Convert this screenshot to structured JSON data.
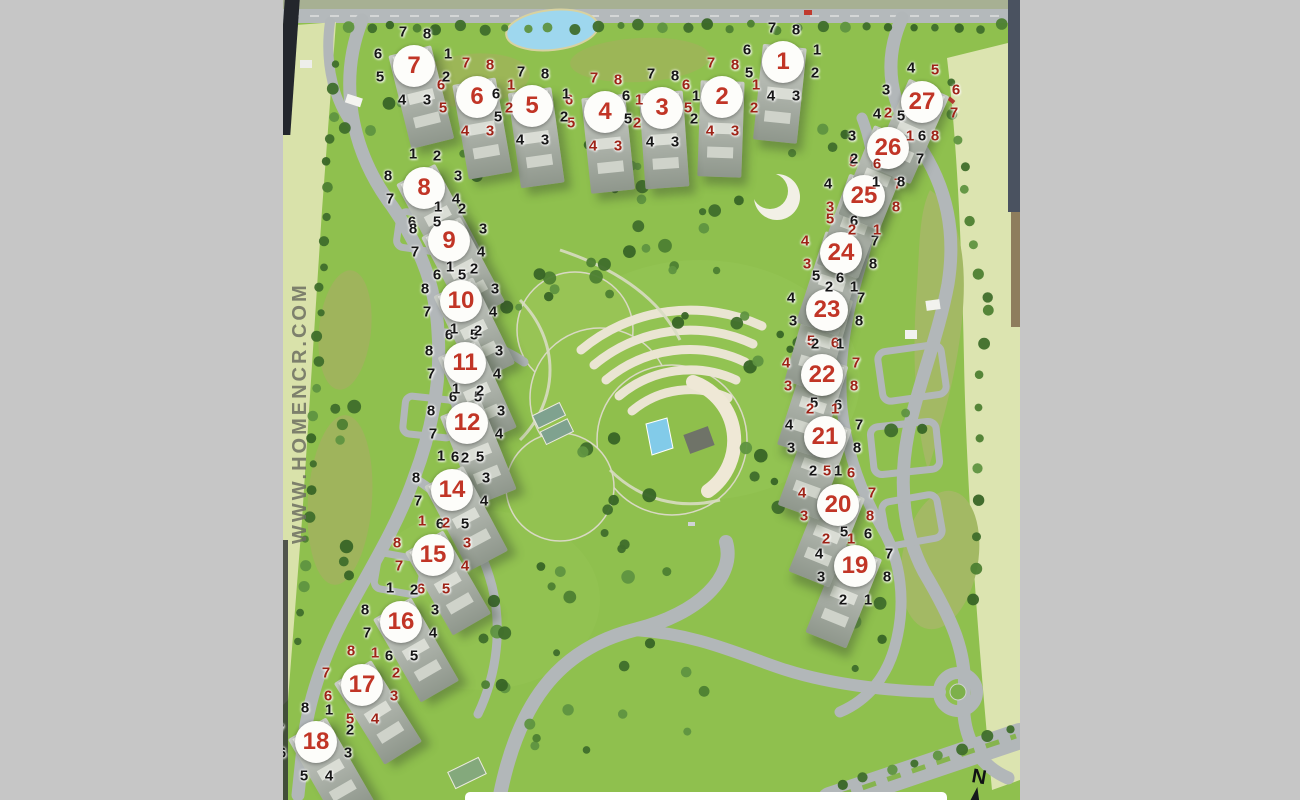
{
  "watermark": "WWW.HOMENCR.COM",
  "compass": {
    "label": "N"
  },
  "colors": {
    "grass": "#8fc04e",
    "pale_band": "#dbe3ac",
    "golf_olive": "#a3b964",
    "road": "#b2b7b9",
    "water": "#8fd0ea",
    "tower_number_red": "#c13526",
    "unit_digit_black": "#161616",
    "unit_digit_red": "#9e2317",
    "badge_white": "#fdfdfa"
  },
  "towers": [
    {
      "label": "1",
      "x": 783,
      "y": 62,
      "rot": 6,
      "digits": [
        [
          "7",
          "k"
        ],
        [
          "8",
          "k"
        ],
        [
          "1",
          "k"
        ],
        [
          "2",
          "k"
        ],
        [
          "3",
          "k"
        ],
        [
          "4",
          "k"
        ],
        [
          "5",
          "k"
        ],
        [
          "6",
          "k"
        ]
      ]
    },
    {
      "label": "2",
      "x": 722,
      "y": 97,
      "rot": 2,
      "digits": [
        [
          "7",
          "r"
        ],
        [
          "8",
          "r"
        ],
        [
          "1",
          "r"
        ],
        [
          "2",
          "r"
        ],
        [
          "3",
          "r"
        ],
        [
          "4",
          "r"
        ],
        [
          "5",
          "r"
        ],
        [
          "6",
          "r"
        ]
      ]
    },
    {
      "label": "3",
      "x": 662,
      "y": 108,
      "rot": -4,
      "digits": [
        [
          "7",
          "k"
        ],
        [
          "8",
          "k"
        ],
        [
          "1",
          "k"
        ],
        [
          "2",
          "k"
        ],
        [
          "3",
          "k"
        ],
        [
          "4",
          "k"
        ],
        [
          "5",
          "k"
        ],
        [
          "6",
          "k"
        ]
      ]
    },
    {
      "label": "4",
      "x": 605,
      "y": 112,
      "rot": -6,
      "digits": [
        [
          "7",
          "r"
        ],
        [
          "8",
          "r"
        ],
        [
          "1",
          "r"
        ],
        [
          "2",
          "r"
        ],
        [
          "3",
          "r"
        ],
        [
          "4",
          "r"
        ],
        [
          "5",
          "r"
        ],
        [
          "6",
          "r"
        ]
      ]
    },
    {
      "label": "5",
      "x": 532,
      "y": 106,
      "rot": -8,
      "digits": [
        [
          "7",
          "k"
        ],
        [
          "8",
          "k"
        ],
        [
          "1",
          "k"
        ],
        [
          "2",
          "k"
        ],
        [
          "3",
          "k"
        ],
        [
          "4",
          "k"
        ],
        [
          "5",
          "k"
        ],
        [
          "6",
          "k"
        ]
      ]
    },
    {
      "label": "6",
      "x": 477,
      "y": 97,
      "rot": -10,
      "digits": [
        [
          "7",
          "r"
        ],
        [
          "8",
          "r"
        ],
        [
          "1",
          "r"
        ],
        [
          "2",
          "r"
        ],
        [
          "3",
          "r"
        ],
        [
          "4",
          "r"
        ],
        [
          "5",
          "r"
        ],
        [
          "6",
          "r"
        ]
      ]
    },
    {
      "label": "7",
      "x": 414,
      "y": 66,
      "rot": -14,
      "digits": [
        [
          "7",
          "k"
        ],
        [
          "8",
          "k"
        ],
        [
          "1",
          "k"
        ],
        [
          "2",
          "k"
        ],
        [
          "3",
          "k"
        ],
        [
          "4",
          "k"
        ],
        [
          "5",
          "k"
        ],
        [
          "6",
          "k"
        ]
      ]
    },
    {
      "label": "8",
      "x": 424,
      "y": 188,
      "rot": -28,
      "digits": [
        [
          "1",
          "k"
        ],
        [
          "2",
          "k"
        ],
        [
          "3",
          "k"
        ],
        [
          "4",
          "k"
        ],
        [
          "5",
          "k"
        ],
        [
          "6",
          "k"
        ],
        [
          "7",
          "k"
        ],
        [
          "8",
          "k"
        ]
      ]
    },
    {
      "label": "9",
      "x": 449,
      "y": 241,
      "rot": -28,
      "digits": [
        [
          "1",
          "k"
        ],
        [
          "2",
          "k"
        ],
        [
          "3",
          "k"
        ],
        [
          "4",
          "k"
        ],
        [
          "5",
          "k"
        ],
        [
          "6",
          "k"
        ],
        [
          "7",
          "k"
        ],
        [
          "8",
          "k"
        ]
      ]
    },
    {
      "label": "10",
      "x": 461,
      "y": 301,
      "rot": -26,
      "digits": [
        [
          "1",
          "k"
        ],
        [
          "2",
          "k"
        ],
        [
          "3",
          "k"
        ],
        [
          "4",
          "k"
        ],
        [
          "5",
          "k"
        ],
        [
          "6",
          "k"
        ],
        [
          "7",
          "k"
        ],
        [
          "8",
          "k"
        ]
      ]
    },
    {
      "label": "11",
      "x": 465,
      "y": 363,
      "rot": -24,
      "digits": [
        [
          "1",
          "k"
        ],
        [
          "2",
          "k"
        ],
        [
          "3",
          "k"
        ],
        [
          "4",
          "k"
        ],
        [
          "5",
          "k"
        ],
        [
          "6",
          "k"
        ],
        [
          "7",
          "k"
        ],
        [
          "8",
          "k"
        ]
      ]
    },
    {
      "label": "12",
      "x": 467,
      "y": 423,
      "rot": -22,
      "digits": [
        [
          "1",
          "k"
        ],
        [
          "2",
          "k"
        ],
        [
          "3",
          "k"
        ],
        [
          "4",
          "k"
        ],
        [
          "5",
          "k"
        ],
        [
          "6",
          "k"
        ],
        [
          "7",
          "k"
        ],
        [
          "8",
          "k"
        ]
      ]
    },
    {
      "label": "14",
      "x": 452,
      "y": 490,
      "rot": -28,
      "digits": [
        [
          "1",
          "k"
        ],
        [
          "2",
          "k"
        ],
        [
          "3",
          "k"
        ],
        [
          "4",
          "k"
        ],
        [
          "5",
          "k"
        ],
        [
          "6",
          "k"
        ],
        [
          "7",
          "k"
        ],
        [
          "8",
          "k"
        ]
      ]
    },
    {
      "label": "15",
      "x": 433,
      "y": 555,
      "rot": -30,
      "digits": [
        [
          "1",
          "r"
        ],
        [
          "2",
          "r"
        ],
        [
          "3",
          "r"
        ],
        [
          "4",
          "r"
        ],
        [
          "5",
          "r"
        ],
        [
          "6",
          "r"
        ],
        [
          "7",
          "r"
        ],
        [
          "8",
          "r"
        ]
      ]
    },
    {
      "label": "16",
      "x": 401,
      "y": 622,
      "rot": -30,
      "digits": [
        [
          "1",
          "k"
        ],
        [
          "2",
          "k"
        ],
        [
          "3",
          "k"
        ],
        [
          "4",
          "k"
        ],
        [
          "5",
          "k"
        ],
        [
          "6",
          "k"
        ],
        [
          "7",
          "k"
        ],
        [
          "8",
          "k"
        ]
      ]
    },
    {
      "label": "17",
      "x": 362,
      "y": 685,
      "rot": -32,
      "digits": [
        [
          "8",
          "r"
        ],
        [
          "1",
          "r"
        ],
        [
          "2",
          "r"
        ],
        [
          "3",
          "r"
        ],
        [
          "4",
          "r"
        ],
        [
          "5",
          "r"
        ],
        [
          "6",
          "r"
        ],
        [
          "7",
          "r"
        ]
      ]
    },
    {
      "label": "18",
      "x": 316,
      "y": 742,
      "rot": -30,
      "digits": [
        [
          "8",
          "k"
        ],
        [
          "1",
          "k"
        ],
        [
          "2",
          "k"
        ],
        [
          "3",
          "k"
        ],
        [
          "4",
          "k"
        ],
        [
          "5",
          "k"
        ],
        [
          "6",
          "k"
        ],
        [
          "7",
          "k"
        ]
      ]
    },
    {
      "label": "19",
      "x": 855,
      "y": 566,
      "rot": 22,
      "digits": [
        [
          "5",
          "k"
        ],
        [
          "6",
          "k"
        ],
        [
          "7",
          "k"
        ],
        [
          "8",
          "k"
        ],
        [
          "1",
          "k"
        ],
        [
          "2",
          "k"
        ],
        [
          "3",
          "k"
        ],
        [
          "4",
          "k"
        ]
      ]
    },
    {
      "label": "20",
      "x": 838,
      "y": 505,
      "rot": 22,
      "digits": [
        [
          "5",
          "r"
        ],
        [
          "6",
          "r"
        ],
        [
          "7",
          "r"
        ],
        [
          "8",
          "r"
        ],
        [
          "1",
          "r"
        ],
        [
          "2",
          "r"
        ],
        [
          "3",
          "r"
        ],
        [
          "4",
          "r"
        ]
      ]
    },
    {
      "label": "21",
      "x": 825,
      "y": 437,
      "rot": 20,
      "digits": [
        [
          "5",
          "k"
        ],
        [
          "6",
          "k"
        ],
        [
          "7",
          "k"
        ],
        [
          "8",
          "k"
        ],
        [
          "1",
          "k"
        ],
        [
          "2",
          "k"
        ],
        [
          "3",
          "k"
        ],
        [
          "4",
          "k"
        ]
      ]
    },
    {
      "label": "22",
      "x": 822,
      "y": 375,
      "rot": 18,
      "digits": [
        [
          "5",
          "r"
        ],
        [
          "6",
          "r"
        ],
        [
          "7",
          "r"
        ],
        [
          "8",
          "r"
        ],
        [
          "1",
          "r"
        ],
        [
          "2",
          "r"
        ],
        [
          "3",
          "r"
        ],
        [
          "4",
          "r"
        ]
      ]
    },
    {
      "label": "23",
      "x": 827,
      "y": 310,
      "rot": 16,
      "digits": [
        [
          "5",
          "k"
        ],
        [
          "6",
          "k"
        ],
        [
          "7",
          "k"
        ],
        [
          "8",
          "k"
        ],
        [
          "1",
          "k"
        ],
        [
          "2",
          "k"
        ],
        [
          "3",
          "k"
        ],
        [
          "4",
          "k"
        ]
      ]
    },
    {
      "label": "24",
      "x": 841,
      "y": 253,
      "rot": 18,
      "digits": [
        [
          "5",
          "r"
        ],
        [
          "6",
          "k"
        ],
        [
          "7",
          "k"
        ],
        [
          "8",
          "k"
        ],
        [
          "1",
          "k"
        ],
        [
          "2",
          "k"
        ],
        [
          "3",
          "r"
        ],
        [
          "4",
          "r"
        ]
      ]
    },
    {
      "label": "25",
      "x": 864,
      "y": 196,
      "rot": 20,
      "digits": [
        [
          "5",
          "r"
        ],
        [
          "6",
          "r"
        ],
        [
          "7",
          "r"
        ],
        [
          "8",
          "r"
        ],
        [
          "1",
          "r"
        ],
        [
          "2",
          "r"
        ],
        [
          "3",
          "r"
        ],
        [
          "4",
          "k"
        ]
      ]
    },
    {
      "label": "26",
      "x": 888,
      "y": 148,
      "rot": 22,
      "digits": [
        [
          "4",
          "k"
        ],
        [
          "5",
          "k"
        ],
        [
          "6",
          "k"
        ],
        [
          "7",
          "k"
        ],
        [
          "8",
          "k"
        ],
        [
          "1",
          "k"
        ],
        [
          "2",
          "k"
        ],
        [
          "3",
          "k"
        ]
      ]
    },
    {
      "label": "27",
      "x": 922,
      "y": 102,
      "rot": 24,
      "digits": [
        [
          "4",
          "k"
        ],
        [
          "5",
          "r"
        ],
        [
          "6",
          "r"
        ],
        [
          "7",
          "r"
        ],
        [
          "8",
          "r"
        ],
        [
          "1",
          "r"
        ],
        [
          "2",
          "r"
        ],
        [
          "3",
          "k"
        ]
      ]
    }
  ]
}
